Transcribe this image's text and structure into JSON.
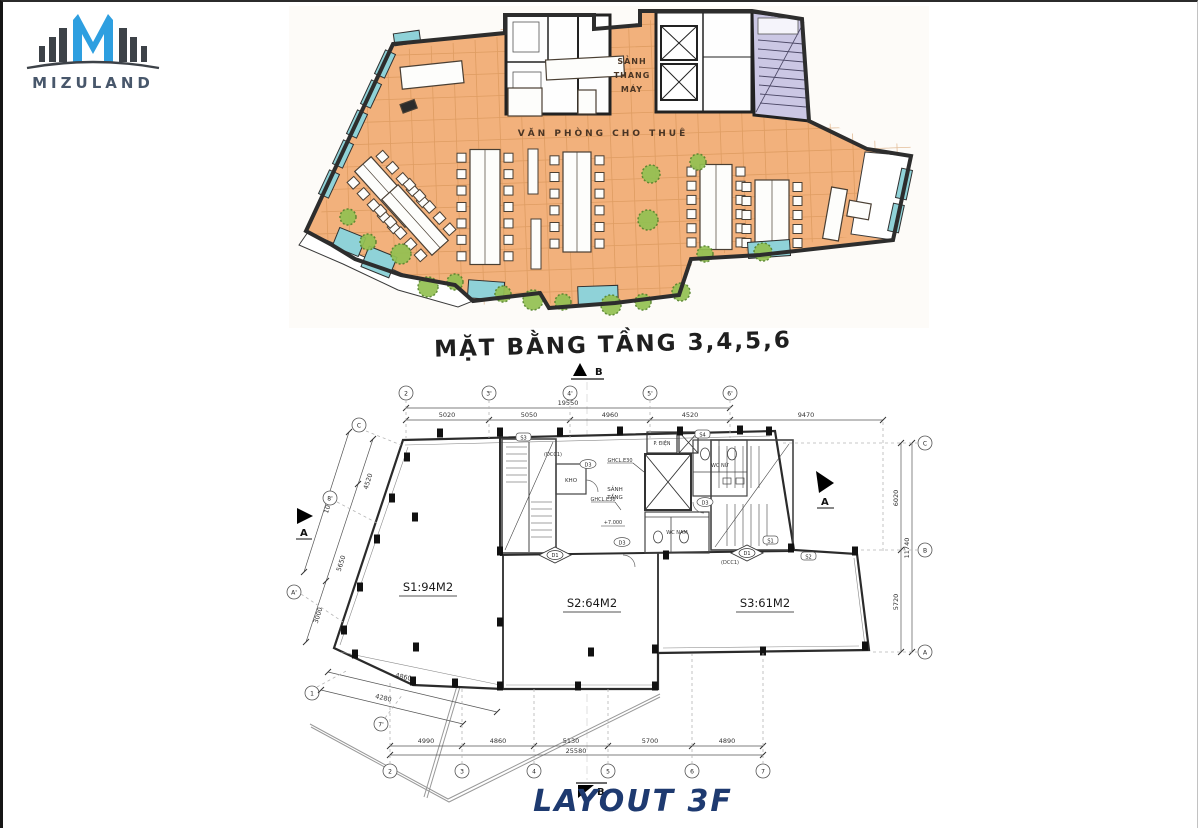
{
  "logo": {
    "brand": "MIZULAND"
  },
  "sketch": {
    "label_elevator_lobby_1": "SẢNH",
    "label_elevator_lobby_2": "THANG",
    "label_elevator_lobby_3": "MÁY",
    "label_office": "VĂN PHÒNG CHO THUÊ"
  },
  "caption": "MẶT BẰNG TẦNG 3,4,5,6",
  "cad": {
    "areas": {
      "s1": "S1:94M2",
      "s2": "S2:64M2",
      "s3": "S3:61M2"
    },
    "rooms": {
      "storage": "KHO",
      "lobby_1": "SẢNH",
      "lobby_2": "TẦNG",
      "wc_men": "WC NAM",
      "wc_women": "WC NỮ",
      "electrical": "P. ĐIỆN"
    },
    "notes": {
      "glass_1": "GHCL.E30",
      "glass_2": "GHCL.E30",
      "level": "+7.000",
      "door_dcc_1": "(DCC1)",
      "door_dcc_2": "(DCC1)",
      "door_d3_1": "D3",
      "door_d3_2": "D3",
      "door_d3_3": "D3",
      "tag_d1_1": "D1",
      "tag_d1_2": "D1",
      "tag_s1": "S1",
      "tag_s2": "S2",
      "tag_s3": "S3",
      "tag_s4": "S4"
    },
    "sections": {
      "a": "A",
      "b": "B"
    },
    "grid_top": [
      "2",
      "3'",
      "4'",
      "5'",
      "6'"
    ],
    "grid_bottom": [
      "2",
      "3",
      "4",
      "5",
      "6",
      "7"
    ],
    "grid_right": [
      "C",
      "B",
      "A"
    ],
    "grid_left": [
      "C",
      "8'",
      "A'",
      "1",
      "7'"
    ],
    "dims_top": [
      "5020",
      "5050",
      "4960",
      "4520",
      "9470"
    ],
    "dims_top_total": "19550",
    "dims_bottom": [
      "4990",
      "4860",
      "5130",
      "5700",
      "4890"
    ],
    "dims_bottom_total": "25580",
    "dims_right": [
      "6020",
      "5720"
    ],
    "dims_right_total": "11740",
    "dims_left": [
      "4520",
      "5650",
      "3000"
    ],
    "dims_left_total": "10190",
    "dims_bottom_left": [
      "4860",
      "4280"
    ]
  },
  "footer": "LAYOUT 3F"
}
